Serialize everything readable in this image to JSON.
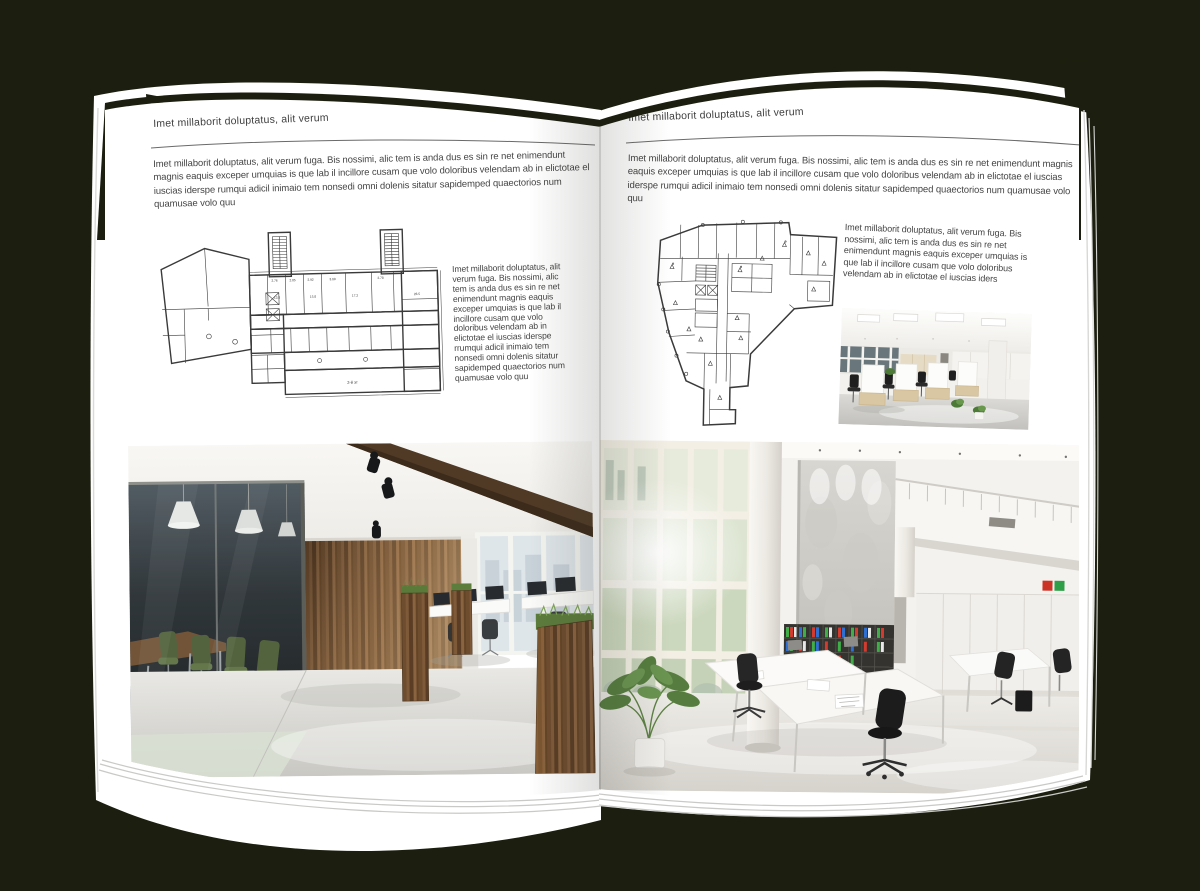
{
  "page_type": "open-brochure-mockup",
  "colors": {
    "background": "#1c1e0f",
    "page": "#ffffff",
    "heading_text": "#3f3f3f",
    "body_text": "#454545",
    "rule": "#666666",
    "plan_ink": "#3a3a3a"
  },
  "left_page": {
    "header": "Imet millaborit doluptatus, alit verum",
    "intro": "Imet millaborit doluptatus, alit verum fuga. Bis nossimi, alic tem is anda dus es sin re net enimendunt magnis eaquis exceper umquias is que lab il incillore cusam que volo doloribus velendam ab in elictotae el iuscias iderspe rumqui adicil inimaio tem nonsedi omni dolenis sitatur sapidemped quaectorios num quamusae volo quu",
    "side_text": "Imet millaborit doluptatus, alit verum fuga. Bis nossimi, alic tem is anda dus es sin re net enimendunt magnis eaquis exceper umquias is que lab il incillore cusam que volo doloribus velendam ab in elictotae el iuscias iderspe rrumqui adicil inimaio tem nonsedi omni dolenis sitatur sapidemped quaectorios num quamusae volo quu",
    "plan_labels": [
      "2.76",
      "2.85",
      "2.92",
      "3.09",
      "2.78",
      "13.8",
      "15.8",
      "17.2",
      "28.5",
      "2-й эт"
    ]
  },
  "right_page": {
    "header": "Imet millaborit doluptatus, alit verum",
    "intro": "Imet millaborit doluptatus, alit verum fuga. Bis nossimi, alic tem is anda dus es sin re net enimendunt magnis eaquis exceper umquias is que lab il incillore cusam que volo doloribus velendam ab in elictotae el iuscias iderspe rumqui adicil inimaio tem nonsedi omni dolenis sitatur sapidemped quaectorios num quamusae volo quu",
    "side_text": "Imet millaborit doluptatus, alit verum fuga. Bis nossimi, alic tem is anda dus es sin re net enimendunt magnis eaquis exceper umquias is que lab il incillore cusam que volo doloribus velendam ab in elictotae el iuscias iders"
  }
}
